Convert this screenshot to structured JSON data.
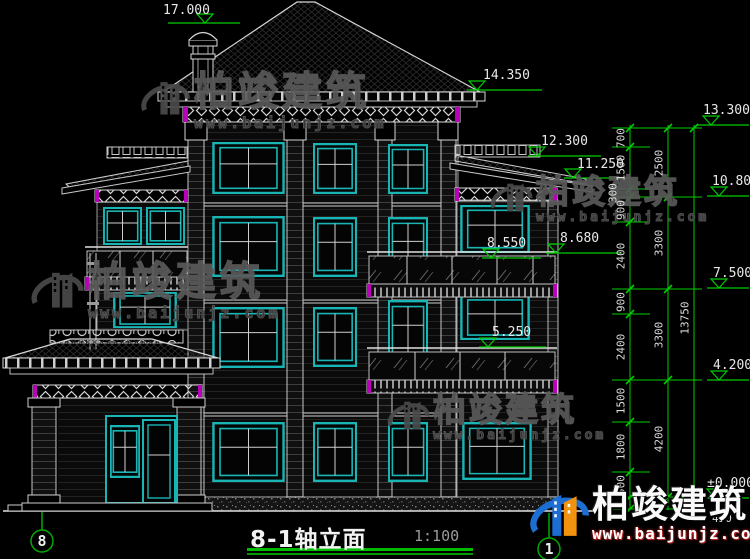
{
  "drawing": {
    "title": "8-1轴立面",
    "scale": "1:100"
  },
  "axis": {
    "left": "8",
    "right": "1"
  },
  "elevations": {
    "chimney_top": "17.000",
    "main_eave": "14.350",
    "parapet_top": "13.300",
    "wing_parapet": "12.300",
    "wing_eave": "11.250",
    "floor4": "10.800",
    "balcony3_left": "8.550",
    "balcony3_right": "8.680",
    "floor3": "7.500",
    "balcony2": "5.250",
    "floor2": "4.200",
    "ground_floor": "±0.000"
  },
  "dimensions": {
    "segments": [
      "700",
      "1500",
      "300",
      "900",
      "2400",
      "900",
      "2400",
      "1500",
      "1800",
      "900"
    ],
    "floors": [
      "2500",
      "3300",
      "3300",
      "4200"
    ],
    "total": "13750",
    "plinth": "450"
  },
  "watermark": {
    "name": "柏竣建筑",
    "url": "www.baijunjz.com"
  },
  "colors": {
    "background": "#000000",
    "line": "#d9d9d9",
    "window_frame": "#19b5b5",
    "dimension_green": "#00cc00",
    "accent_magenta": "#bb00bb",
    "logo_blue": "#1c6ed2",
    "logo_orange": "#f2930f"
  }
}
